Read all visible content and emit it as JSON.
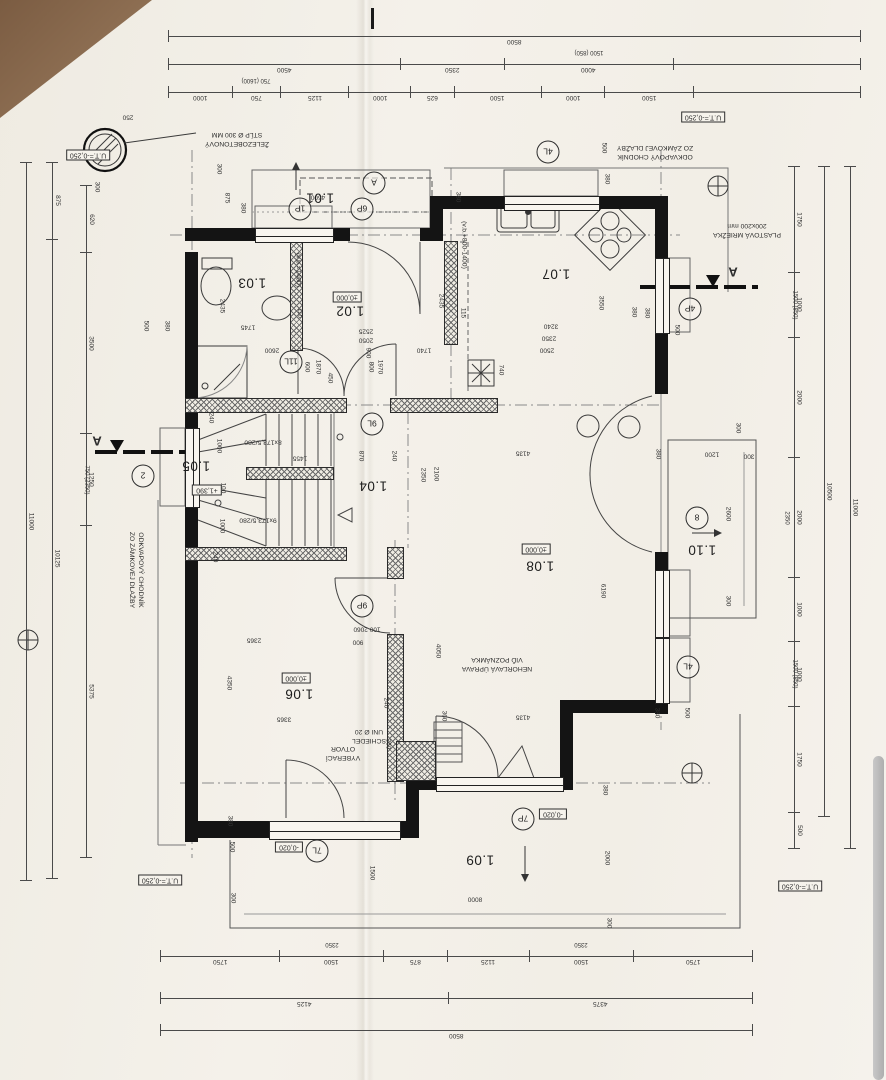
{
  "plan": {
    "rooms": {
      "r101": "1.01",
      "r102": "1.02",
      "r103": "1.03",
      "r104": "1.04",
      "r105": "1.05",
      "r106": "1.06",
      "r107": "1.07",
      "r108": "1.08",
      "r109": "1.09",
      "r110": "1.10"
    },
    "levels": {
      "terrain": "U.T.=-0,250",
      "floor": "±0,000",
      "stair": "+1,390",
      "terrace": "-0,020"
    },
    "marks": {
      "m1p": "1P",
      "m6p": "6P",
      "mA": "A",
      "m4l_top": "4L",
      "m4p": "4P",
      "m8": "8",
      "m4l_right": "4L",
      "m11l": "11L",
      "m9l": "9L",
      "m9p": "9P",
      "m7l": "7L",
      "m7p": "7P",
      "m2": "2",
      "section_letter": "A"
    },
    "stairs": {
      "flight_up": "8x173,5/280",
      "flight_down": "9x173,5/280"
    },
    "annotations": {
      "column1": "ŽELEZOBETONOVÝ",
      "column2": "STĹP Ø 300 MM",
      "gutter1": "ODKVAPOVÝ CHODNÍK",
      "gutter2": "ZO ZÁMKOVEJ DLAŽBY",
      "grille1": "PLASTOVÁ MRIEŽKA",
      "grille2": "200x200 mm",
      "fire1": "NEHORĽAVÁ ÚPRAVA",
      "fire2": "VIĎ POZNÁMKA",
      "soot1": "VYBERACÍ",
      "soot2": "OTVOR",
      "chimney1": "SCHIEDEL",
      "chimney2": "UNI Ø 20",
      "parapet1": "(v.b.+800-1400)",
      "parapet2": "(v.b.=1400)"
    },
    "dims": {
      "top1": [
        {
          "t": "8500",
          "v": 1
        }
      ],
      "top2": [
        {
          "t": "4500",
          "v": 232
        },
        {
          "t": "2350",
          "v": 95
        },
        {
          "t": "4000",
          "s": "1500 (850)",
          "v": 165
        },
        {
          "t": "",
          "v": 200
        }
      ],
      "top3": [
        {
          "t": "1000",
          "v": 58
        },
        {
          "t": "750",
          "s": "750 (1600)",
          "v": 44
        },
        {
          "t": "1125",
          "v": 64
        },
        {
          "t": "1000",
          "v": 56
        },
        {
          "t": "625",
          "v": 38
        },
        {
          "t": "1500",
          "v": 86
        },
        {
          "t": "1000",
          "v": 58
        },
        {
          "t": "1500",
          "v": 88
        },
        {
          "t": "",
          "v": 200
        }
      ],
      "bottom1": [
        {
          "t": "1750",
          "v": 1750
        },
        {
          "t": "1500",
          "s": "2350",
          "v": 1500
        },
        {
          "t": "875",
          "v": 875
        },
        {
          "t": "1125",
          "v": 1125
        },
        {
          "t": "1500",
          "s": "2350",
          "v": 1500
        },
        {
          "t": "1750",
          "v": 1750
        }
      ],
      "bottom2": [
        {
          "t": "4125",
          "v": 4125
        },
        {
          "t": "4375",
          "v": 4375
        }
      ],
      "bottom3": [
        {
          "t": "8500",
          "v": 1
        }
      ],
      "left_inner": [
        {
          "t": "620",
          "v": 62
        },
        {
          "t": "3500",
          "v": 180
        },
        {
          "t": "1250",
          "s": "750 (2350)",
          "v": 88
        },
        {
          "t": "5375",
          "v": 338
        }
      ],
      "left_mid": [
        {
          "t": "875",
          "v": 70
        },
        {
          "t": "10125",
          "v": 642
        }
      ],
      "left_outer": [
        {
          "t": "11000",
          "v": 1
        }
      ],
      "right_inner": [
        {
          "t": "1750",
          "v": 112
        },
        {
          "t": "1000",
          "s": "1500 (850)",
          "v": 64
        },
        {
          "t": "2000",
          "v": 128
        },
        {
          "t": "2000",
          "s": "2350",
          "v": 128
        },
        {
          "t": "1000",
          "v": 64
        },
        {
          "t": "1000",
          "s": "1500 (850)",
          "v": 64
        },
        {
          "t": "1750",
          "v": 112
        },
        {
          "t": "500",
          "v": 32
        }
      ],
      "right_mid": [
        {
          "t": "10500",
          "v": 1
        }
      ],
      "right_outer": [
        {
          "t": "11000",
          "v": 1
        }
      ]
    },
    "wall_dims": [
      "250",
      "300",
      "300",
      "875",
      "380",
      "4500",
      "500",
      "380",
      "380",
      "500",
      "380",
      "2435",
      "1745",
      "115",
      "500",
      "380",
      "2600",
      "600",
      "1870",
      "450",
      "2525",
      "2050",
      "900",
      "800",
      "1970",
      "2435",
      "115",
      "3550",
      "3240",
      "2350",
      "2500",
      "740",
      "380",
      "1740",
      "240",
      "1455",
      "870",
      "240",
      "2350",
      "2100",
      "240",
      "2365",
      "4350",
      "3365",
      "4135",
      "6190",
      "4050",
      "100 2060",
      "900",
      "240",
      "360",
      "360",
      "380",
      "500",
      "4135",
      "380",
      "2000",
      "300",
      "8000",
      "300",
      "1500",
      "1200",
      "300",
      "300",
      "2600",
      "300",
      "380",
      "380",
      "500",
      "100",
      "1000",
      "1000"
    ]
  }
}
